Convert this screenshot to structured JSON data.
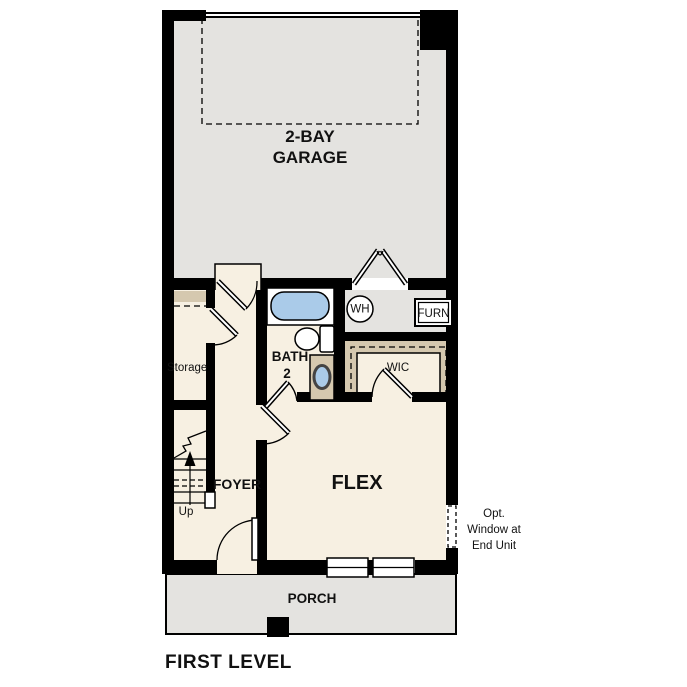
{
  "title": "FIRST LEVEL",
  "rooms": {
    "garage": {
      "line1": "2-BAY",
      "line2": "GARAGE"
    },
    "storage": {
      "label": "Storage"
    },
    "bath": {
      "line1": "BATH",
      "line2": "2"
    },
    "wic": {
      "label": "WIC"
    },
    "foyer": {
      "label": "FOYER"
    },
    "flex": {
      "label": "FLEX"
    },
    "porch": {
      "label": "PORCH"
    }
  },
  "fixtures": {
    "water_heater": "WH",
    "furnace": "FURN"
  },
  "stairs": {
    "up": "Up"
  },
  "annotation": {
    "line1": "Opt.",
    "line2": "Window at",
    "line3": "End Unit"
  },
  "colors": {
    "wall": "#000000",
    "garage_floor": "#e4e3e0",
    "room_floor": "#f7f0e2",
    "shelf_tan": "#d5c8af",
    "fixture_blue": "#aacbe9"
  }
}
